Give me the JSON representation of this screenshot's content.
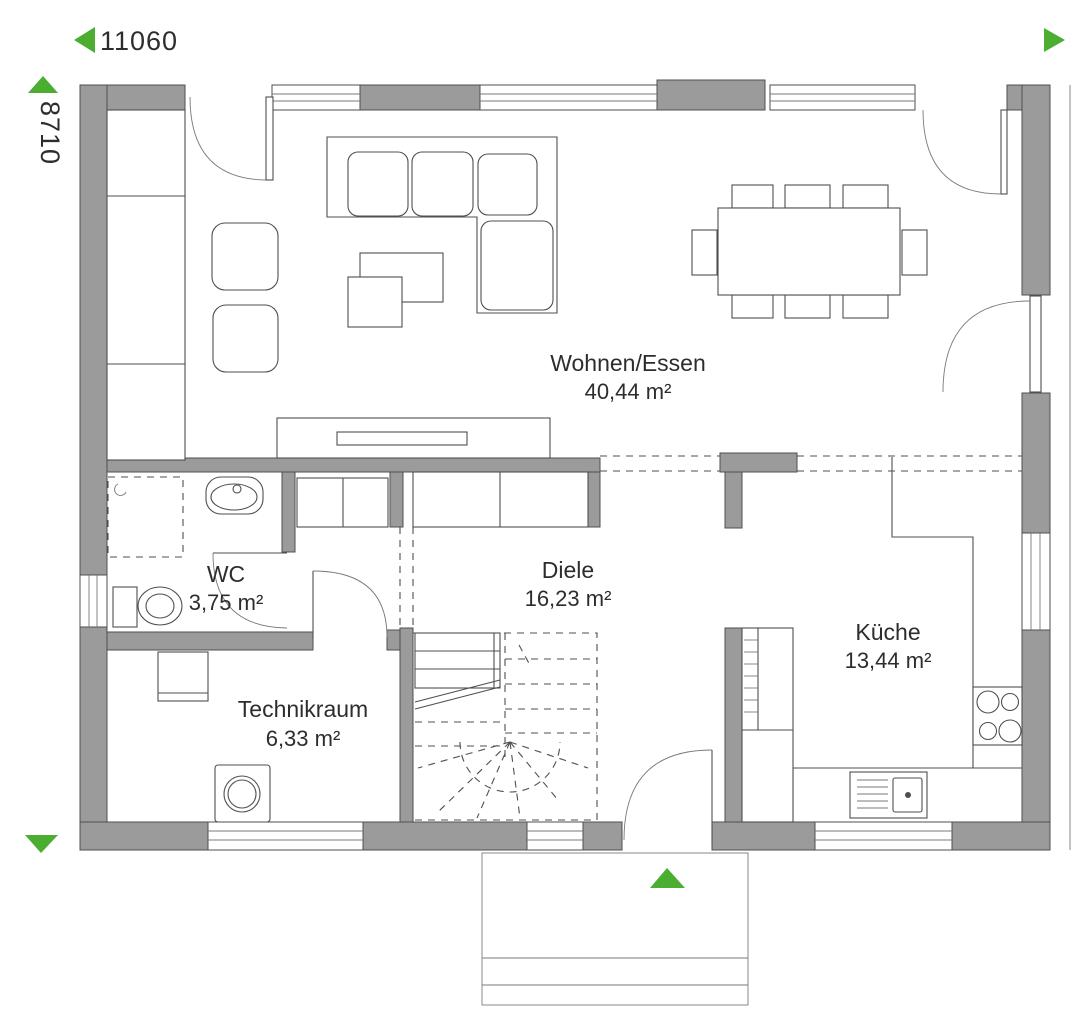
{
  "plan": {
    "dimensions": {
      "width_label": "11060",
      "depth_label": "8710"
    },
    "rooms": [
      {
        "name": "Wohnen/Essen",
        "area": "40,44 m²"
      },
      {
        "name": "Diele",
        "area": "16,23 m²"
      },
      {
        "name": "Küche",
        "area": "13,44 m²"
      },
      {
        "name": "WC",
        "area": "3,75 m²"
      },
      {
        "name": "Technikraum",
        "area": "6,33 m²"
      }
    ],
    "colors": {
      "wall_fill": "#9b9b9b",
      "accent_green": "#4cae30",
      "line": "#4f4f4f",
      "text": "#2d2d2d"
    },
    "icons": [
      "dimension-arrow-left",
      "dimension-arrow-right",
      "dimension-arrow-up",
      "dimension-arrow-down",
      "entrance-arrow-up"
    ]
  }
}
